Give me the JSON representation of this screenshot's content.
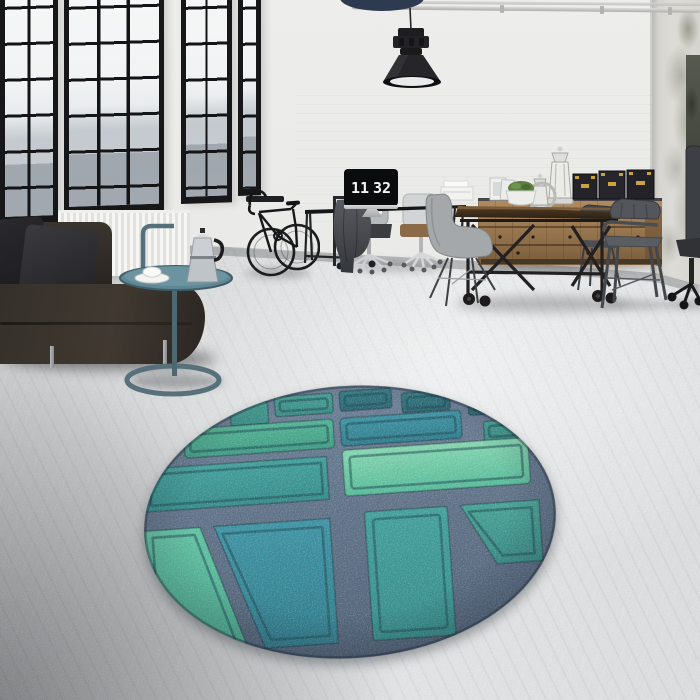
{
  "scene": {
    "description": "Industrial loft interior photograph: black-framed factory windows, white walls, polished concrete floor, dark leather sofa, side table with moka pot, bicycle, desk with flip-clock monitor, wooden sideboard, industrial dining table with metal chairs, black pendant lamp, and a round teal patterned rug in the foreground",
    "clock": {
      "hours": "11",
      "minutes": "32",
      "display": "11 32"
    },
    "objects": [
      "pendant-lamp",
      "ceiling-pipes",
      "factory-windows",
      "city-view",
      "radiator",
      "leather-sofa",
      "cushions",
      "side-table",
      "coffee-cup",
      "moka-pot",
      "bicycle",
      "wall-rack",
      "monitor-flip-clock",
      "office-desk",
      "office-chairs",
      "garment-rack-jacket",
      "printer-papers",
      "wooden-sideboard",
      "black-storage-boxes",
      "lanterns",
      "potted-plant",
      "picture-frames",
      "industrial-table",
      "shell-chair",
      "metal-armchairs",
      "office-chair",
      "distressed-corner-wall",
      "round-teal-rug"
    ],
    "palette": {
      "wall": "#e9e9e7",
      "floor_light": "#e3e4e5",
      "floor_dark": "#8c8e90",
      "window_frame": "#17171a",
      "sofa_leather": "#2f2a25",
      "sideboard_wood": "#9a7850",
      "table_wood": "#3f2f22",
      "metal_chair": "#4c5054",
      "rug_band": "#5e7186",
      "rug_teal_dark": "#2d7580",
      "rug_teal": "#3b9b96",
      "rug_green": "#48aa8e",
      "rug_green_light": "#62c6a1"
    },
    "rug": {
      "shape": "round",
      "pattern": "grid of embossed rectangular panels separated by denim-blue bands, diagonal dividers in lower half"
    }
  }
}
